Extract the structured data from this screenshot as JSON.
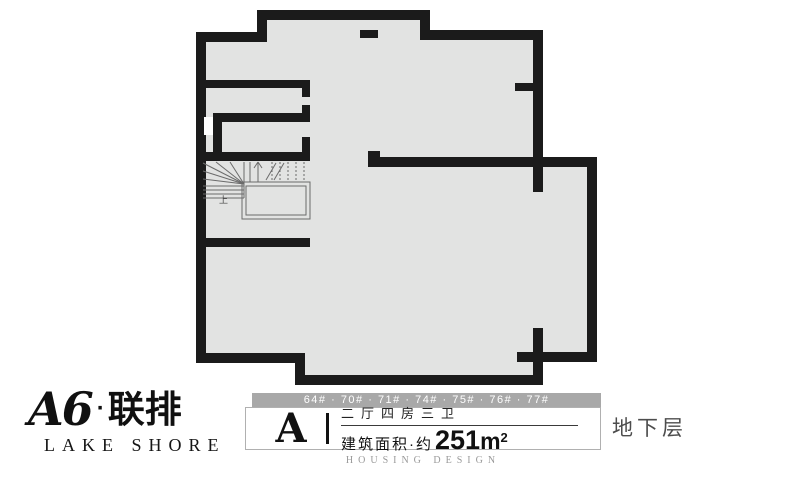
{
  "colors": {
    "wall": "#1b1b1b",
    "floor": "#e2e3e2",
    "banner": "#a8a8a8"
  },
  "logo": {
    "title_latin": "A6",
    "title_sep": "·",
    "title_cn": "联排",
    "subtitle": "LAKE SHORE"
  },
  "info": {
    "buildings": "64# · 70# · 71# · 74# · 75# · 76# · 77#",
    "unit": "A",
    "layout": "二厅四房三卫",
    "area_prefix": "建筑面积·约",
    "area_value": "251",
    "area_unit": "m",
    "area_sup": "2",
    "design_caption": "HOUSING DESIGN"
  },
  "floor_label": "地下层",
  "floorplan": {
    "stair_up_label": "上"
  }
}
